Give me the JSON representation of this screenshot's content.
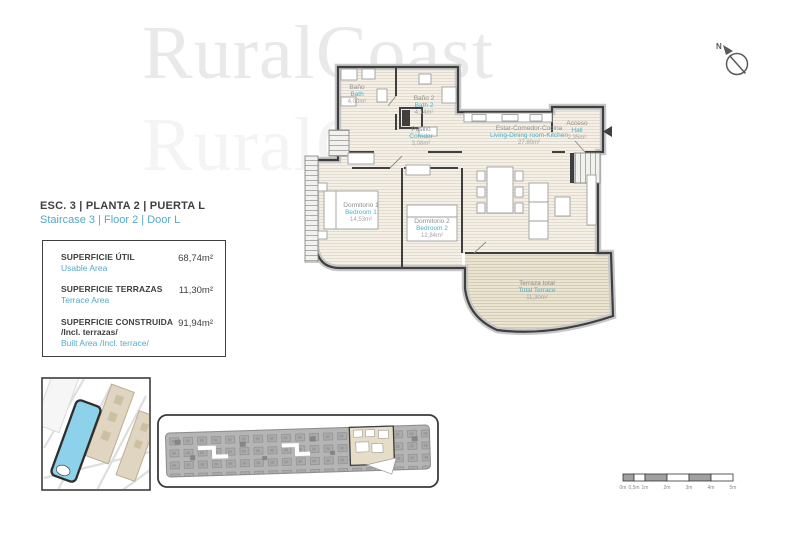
{
  "watermark": "RuralCoast",
  "compass": {
    "north": "N"
  },
  "header": {
    "title": "ESC. 3 | PLANTA 2 | PUERTA L",
    "subtitle": "Staircase 3 | Floor 2 | Door L"
  },
  "areas": {
    "rows": [
      {
        "label": "SUPERFICIE ÚTIL",
        "label_en": "Usable Area",
        "value": "68,74m²"
      },
      {
        "label": "SUPERFICIE TERRAZAS",
        "label_en": "Terrace Area",
        "value": "11,30m²"
      },
      {
        "label": "SUPERFICIE CONSTRUIDA",
        "sublabel": "/Incl. terrazas/",
        "label_en": "Built Area /Incl. terrace/",
        "value": "91,94m²"
      }
    ]
  },
  "floorplan": {
    "rooms": [
      {
        "es": "Baño",
        "en": "Bath",
        "area": "4,00m²"
      },
      {
        "es": "Baño 2",
        "en": "Bath 2",
        "area": "4,14m²"
      },
      {
        "es": "Pasillo",
        "en": "Corridor",
        "area": "3,08m²"
      },
      {
        "es": "Estar-Comedor-Cocina",
        "en": "Living-Dining room-Kitchen",
        "area": "27,80m²"
      },
      {
        "es": "Acceso",
        "en": "Hall",
        "area": "2,35m²"
      },
      {
        "es": "Dormitorio 1",
        "en": "Bedroom 1",
        "area": "14,53m²"
      },
      {
        "es": "Dormitorio 2",
        "en": "Bedroom 2",
        "area": "12,84m²"
      },
      {
        "es": "Terraza total",
        "en": "Total Terrace",
        "area": "11,30m²"
      }
    ]
  },
  "scalebar": {
    "labels": [
      "0m",
      "0,5m",
      "1m",
      "2m",
      "3m",
      "4m",
      "5m"
    ]
  },
  "colors": {
    "accent_blue": "#55a8c7",
    "room_label_blue": "#4fb0ca",
    "wall_dark": "#3f3f3f",
    "floor_hatch": "#f4f0e7",
    "terrace_hatch": "#ebe4d3",
    "site_highlight_blue": "#8ed1ea",
    "keyplan_highlight_beige": "#e7ddc7"
  }
}
